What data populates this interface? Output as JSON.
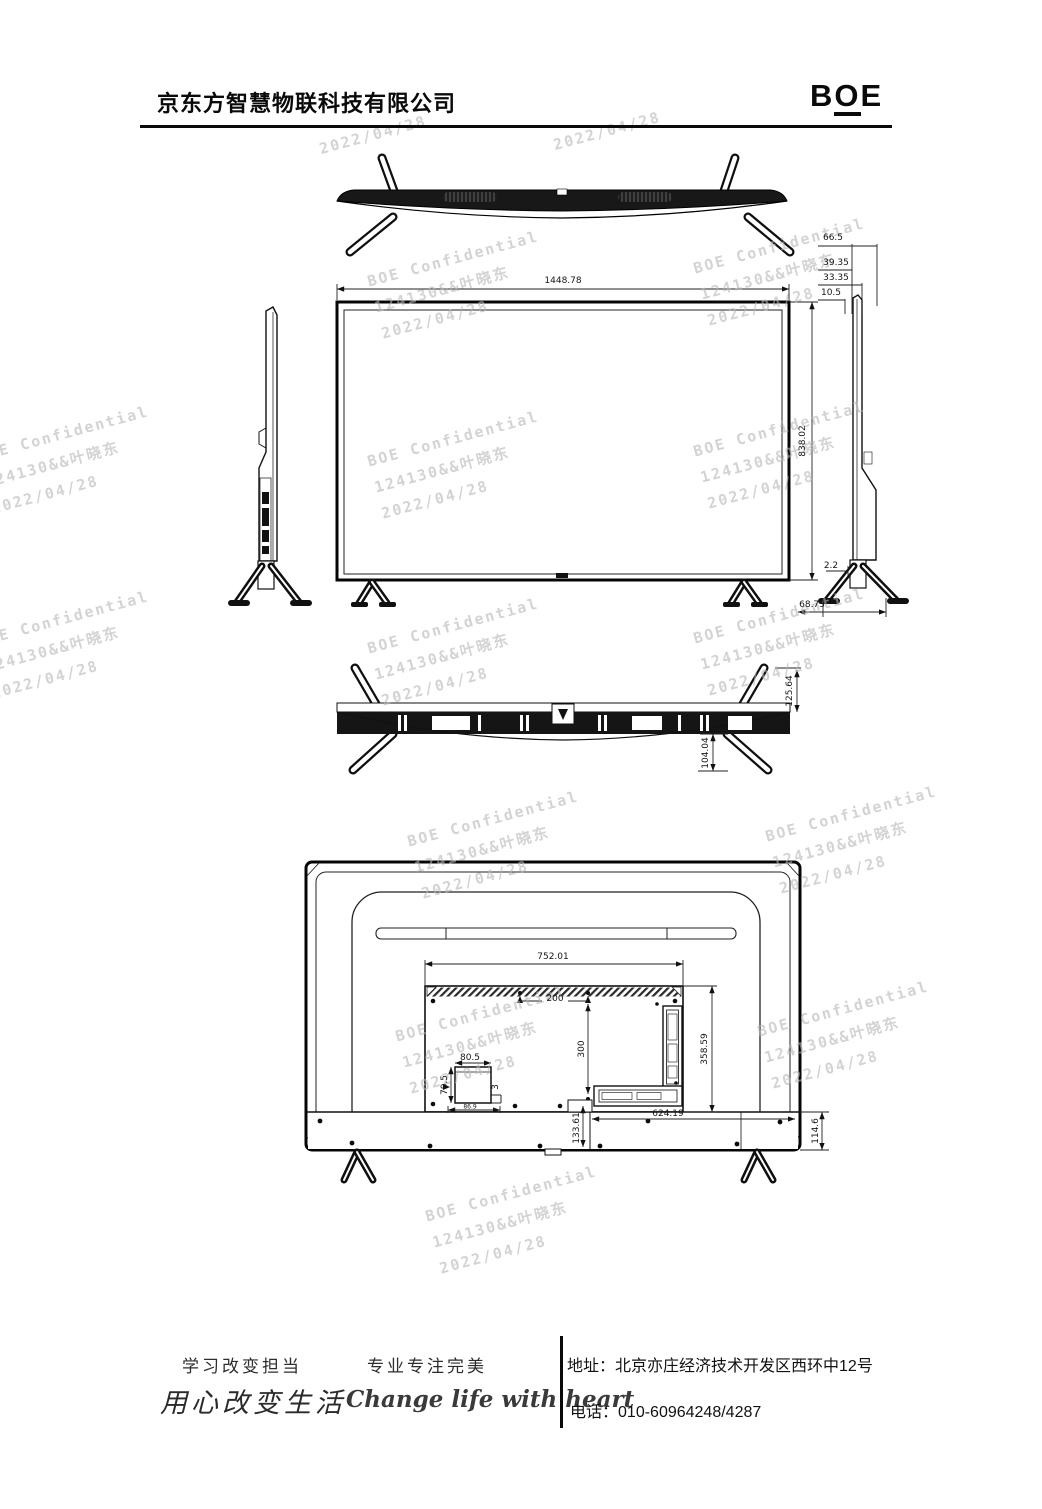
{
  "header": {
    "company": "京东方智慧物联科技有限公司",
    "logo_b": "B",
    "logo_o": "O",
    "logo_e": "E"
  },
  "watermark": {
    "line1": "BOE Confidential",
    "line2": "124130&&叶晓东",
    "line3": "2022/04/28"
  },
  "dims": {
    "front_width": "1448.78",
    "front_height": "838.02",
    "edge_d1": "66.5",
    "edge_d2": "39.35",
    "edge_d3": "33.35",
    "edge_d4": "10.5",
    "gap": "2.2",
    "stand_depth": "68.73",
    "bottom_leg_span": "125.64",
    "bottom_leg_drop": "104.04",
    "rear_panel_width": "752.01",
    "vesa_horizontal": "200",
    "vesa_vertical": "300",
    "rear_panel_height": "358.59",
    "jack_box_width": "80.5",
    "jack_box_height": "70.5",
    "jack_step": "3",
    "jack_offset": "86.9",
    "base_span": "624.19",
    "base_offset": "133.61",
    "base_height": "114.6"
  },
  "footer": {
    "slogan_study": "学习改变担当",
    "slogan_pro": "专业专注完美",
    "script_cn": "用心改变生活",
    "script_en": "Change life with heart",
    "address_label": "地址：",
    "address": "北京亦庄经济技术开发区西环中12号",
    "phone_label": "电话：",
    "phone": "010-60964248/4287"
  }
}
